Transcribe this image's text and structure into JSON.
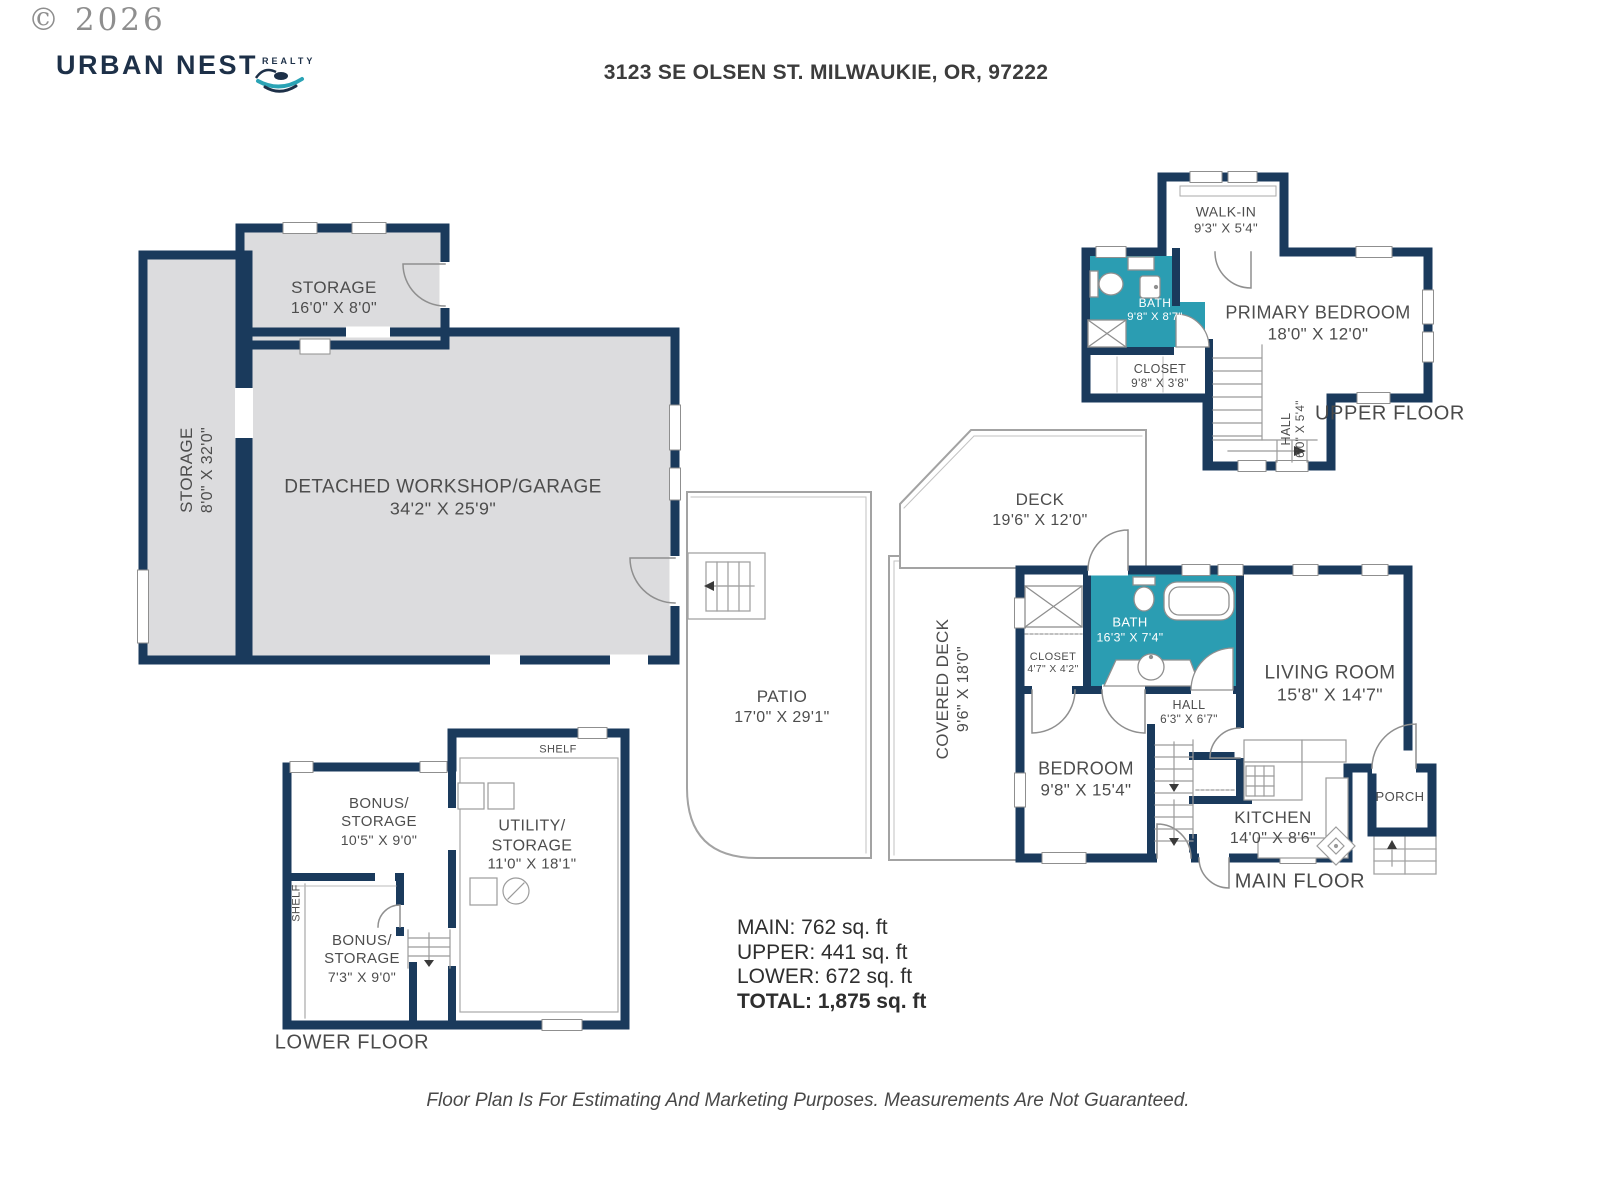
{
  "header": {
    "copyright": "© 2026",
    "brand": "URBAN NEST",
    "brand_sub": "REALTY",
    "address": "3123 SE OLSEN ST. MILWAUKIE, OR, 97222"
  },
  "garage": {
    "storage_top": {
      "name": "STORAGE",
      "dims": "16'0\" X 8'0\""
    },
    "storage_left": {
      "name": "STORAGE",
      "dims": "8'0\" X 32'0\""
    },
    "workshop": {
      "name": "DETACHED WORKSHOP/GARAGE",
      "dims": "34'2\" X 25'9\""
    }
  },
  "upper": {
    "label": "UPPER FLOOR",
    "walk_in": {
      "name": "WALK-IN",
      "dims": "9'3\" X 5'4\""
    },
    "bath": {
      "name": "BATH",
      "dims": "9'8\" X 8'7\""
    },
    "closet": {
      "name": "CLOSET",
      "dims": "9'8\" X 3'8\""
    },
    "primary_bedroom": {
      "name": "PRIMARY BEDROOM",
      "dims": "18'0\" X 12'0\""
    },
    "hall": {
      "name": "HALL",
      "dims": "6'0\" X 5'4\""
    }
  },
  "main": {
    "label": "MAIN FLOOR",
    "deck": {
      "name": "DECK",
      "dims": "19'6\" X 12'0\""
    },
    "covered_deck": {
      "name": "COVERED DECK",
      "dims": "9'6\" X 18'0\""
    },
    "patio": {
      "name": "PATIO",
      "dims": "17'0\" X 29'1\""
    },
    "bath": {
      "name": "BATH",
      "dims": "16'3\" X 7'4\""
    },
    "closet": {
      "name": "CLOSET",
      "dims": "4'7\" X 4'2\""
    },
    "living_room": {
      "name": "LIVING ROOM",
      "dims": "15'8\" X 14'7\""
    },
    "hall": {
      "name": "HALL",
      "dims": "6'3\" X 6'7\""
    },
    "bedroom": {
      "name": "BEDROOM",
      "dims": "9'8\" X 15'4\""
    },
    "kitchen": {
      "name": "KITCHEN",
      "dims": "14'0\" X 8'6\""
    },
    "porch": {
      "name": "PORCH"
    }
  },
  "lower": {
    "label": "LOWER FLOOR",
    "shelf_top": "SHELF",
    "shelf_left": "SHELF",
    "bonus_storage_1": {
      "name": "BONUS/",
      "name2": "STORAGE",
      "dims": "10'5\" X 9'0\""
    },
    "utility": {
      "name": "UTILITY/",
      "name2": "STORAGE",
      "dims": "11'0\" X 18'1\""
    },
    "bonus_storage_2": {
      "name": "BONUS/",
      "name2": "STORAGE",
      "dims": "7'3\" X 9'0\""
    }
  },
  "summary": {
    "main": "MAIN: 762 sq. ft",
    "upper": "UPPER: 441 sq. ft",
    "lower": "LOWER: 672 sq. ft",
    "total": "TOTAL: 1,875 sq. ft"
  },
  "disclaimer": "Floor Plan Is For Estimating And Marketing Purposes. Measurements Are Not Guaranteed.",
  "colors": {
    "wall_navy": "#1a3a5c",
    "bath_teal": "#2b9db2",
    "garage_gray": "#dcdcde",
    "accent_teal": "#2aa3b5"
  }
}
